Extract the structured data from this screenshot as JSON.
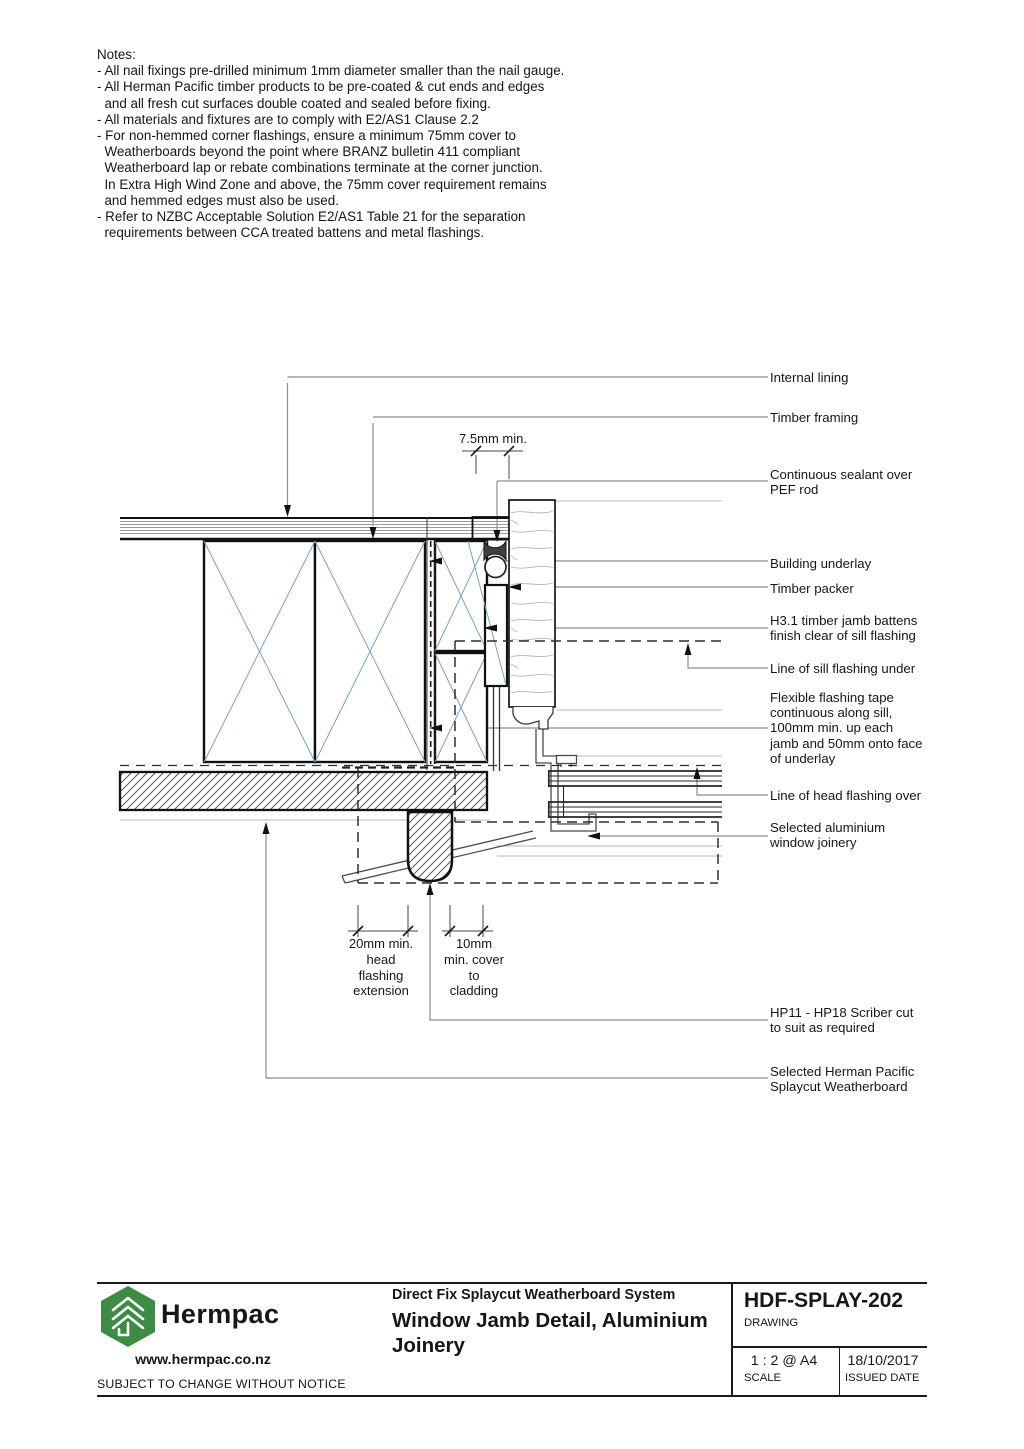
{
  "notes": {
    "lines": [
      "Notes:",
      "- All nail fixings pre-drilled minimum 1mm diameter smaller than the nail gauge.",
      "- All Herman Pacific timber products to be pre-coated & cut ends and edges",
      "  and all fresh cut surfaces double coated and sealed before fixing.",
      "- All materials and fixtures are to comply with E2/AS1 Clause 2.2",
      "- For non-hemmed corner flashings, ensure a minimum 75mm cover to",
      "  Weatherboards beyond the point where BRANZ bulletin 411 compliant",
      "  Weatherboard lap or rebate combinations terminate at the corner junction.",
      "  In Extra High Wind Zone and above, the 75mm cover requirement remains",
      "  and hemmed edges must also be used.",
      "- Refer to NZBC Acceptable Solution E2/AS1 Table 21 for the separation",
      "  requirements between CCA treated battens and metal flashings."
    ]
  },
  "callouts": {
    "internal_lining": "Internal lining",
    "timber_framing": "Timber framing",
    "sealant": "Continuous sealant over\nPEF rod",
    "building_underlay": "Building underlay",
    "timber_packer": "Timber packer",
    "jamb_battens": "H3.1 timber jamb battens\nfinish clear of sill flashing",
    "sill_flashing": "Line of sill flashing under",
    "flashing_tape": "Flexible flashing tape\ncontinuous along sill,\n100mm min. up each\njamb and 50mm onto face\nof underlay",
    "head_flashing": "Line of head flashing over",
    "aluminium_joinery": "Selected aluminium\nwindow joinery",
    "scriber": "HP11 - HP18 Scriber cut\nto suit as required",
    "splaycut_weatherboard": "Selected Herman Pacific\nSplaycut Weatherboard"
  },
  "dimensions": {
    "top_gap": "7.5mm min.",
    "head_flashing_extension": "20mm min.\nhead\nflashing\nextension",
    "cover_to_cladding": "10mm\nmin. cover\nto\ncladding"
  },
  "title_block": {
    "brand": "Hermpac",
    "website": "www.hermpac.co.nz",
    "notice": "SUBJECT TO CHANGE WITHOUT NOTICE",
    "system": "Direct Fix Splaycut Weatherboard System",
    "drawing_title": "Window Jamb Detail, Aluminium\nJoinery",
    "code": "HDF-SPLAY-202",
    "code_label": "DRAWING",
    "scale": "1 : 2 @ A4",
    "scale_label": "SCALE",
    "date": "18/10/2017",
    "date_label": "ISSUED DATE"
  },
  "colors": {
    "line": "#1a1a1a",
    "leader": "#8c8c8c",
    "beyond_line": "#b8b8b8",
    "cross_blue": "#7e9fc5",
    "logo_green": "#3e8b46"
  }
}
